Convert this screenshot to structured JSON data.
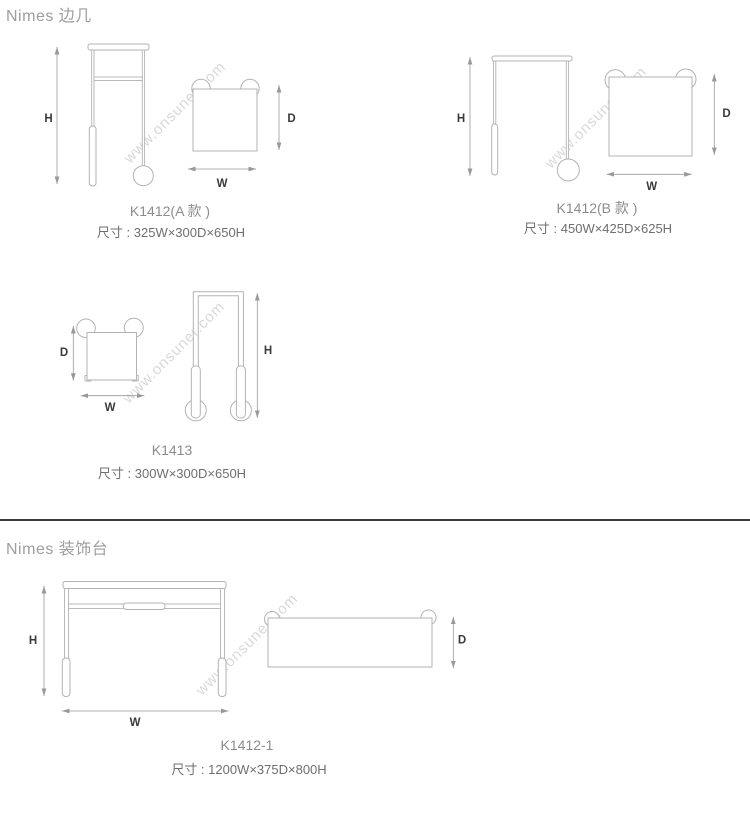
{
  "sections": [
    {
      "heading": "Nimes 边几",
      "products": [
        {
          "model": "K1412(A 款 )",
          "size": "尺寸 : 325W×300D×650H"
        },
        {
          "model": "K1412(B 款 )",
          "size": "尺寸 : 450W×425D×625H"
        },
        {
          "model": "K1413",
          "size": "尺寸 : 300W×300D×650H"
        }
      ]
    },
    {
      "heading": "Nimes 装饰台",
      "products": [
        {
          "model": "K1412-1",
          "size": "尺寸 : 1200W×375D×800H"
        }
      ]
    }
  ],
  "dims": {
    "height": "H",
    "width": "W",
    "depth": "D"
  },
  "watermark": {
    "text": "www.onsuner.com",
    "color": "#d8d8d8"
  },
  "colors": {
    "background": "#ffffff",
    "drawing_line": "#b3b3b3",
    "dimension_line": "#999999",
    "dimension_text": "#3a3a3a",
    "model_text": "#8c8c8c",
    "size_text": "#6f6f6f",
    "heading_text": "#9e9e9e",
    "divider": "#3a3a3a"
  }
}
